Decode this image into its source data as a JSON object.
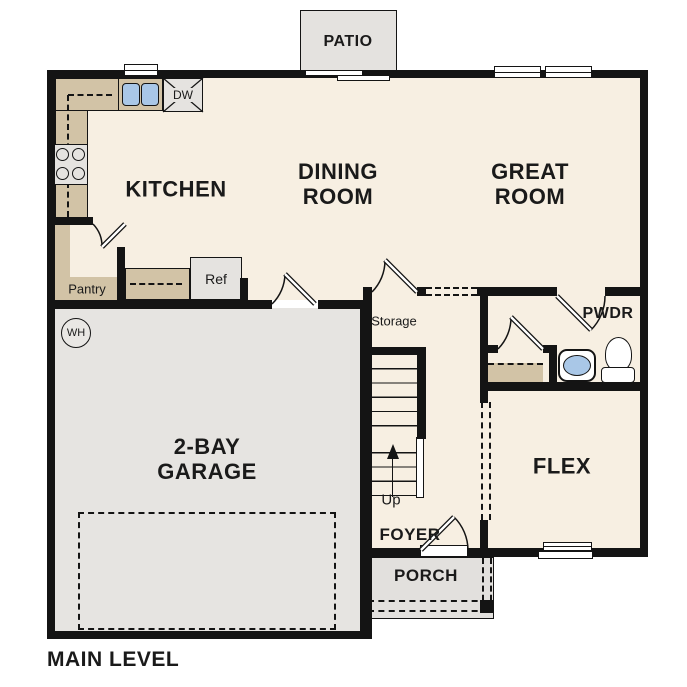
{
  "plan": {
    "title": "MAIN LEVEL",
    "rooms": {
      "kitchen": "KITCHEN",
      "dining": [
        "DINING",
        "ROOM"
      ],
      "great": [
        "GREAT",
        "ROOM"
      ],
      "garage": [
        "2-BAY",
        "GARAGE"
      ],
      "flex": "FLEX",
      "foyer": "FOYER",
      "porch": "PORCH",
      "patio": "PATIO",
      "powder": "PWDR",
      "storage": "Storage",
      "pantry": "Pantry"
    },
    "annotations": {
      "up": "Up"
    },
    "appliances": {
      "ref": "Ref",
      "dishwasher": "DW",
      "water_heater": "WH"
    },
    "colors": {
      "floor": "#F7EFE2",
      "garage_floor": "#E6E4E1",
      "porch_floor": "#E2E0DD",
      "counter": "#D2C3A6",
      "fixture_blue": "#A9C7E7",
      "wall": "#141414"
    }
  }
}
